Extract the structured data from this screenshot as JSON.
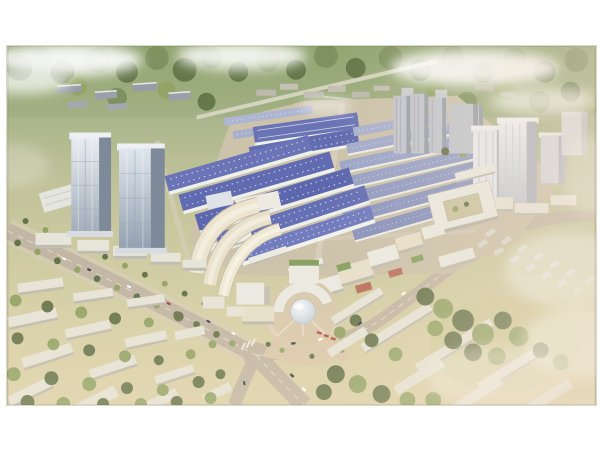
{
  "scene": {
    "type": "aerial-architectural-rendering-photo",
    "description": "Photographed aerial rendering of a planned industrial and commercial park: rows of blue-roofed logistics warehouses, twin glass office towers on the left, a circular plaza with a central dome surrounded by a ring building and fan-shaped cream offices, a white courtyard building and high-rise tower cluster on the right, residential slab towers behind, tree-lined avenues crossing at an intersection in the foreground, low-rise housing blocks among trees at bottom left and right, distant forest, fields and haze clouds at the top",
    "regions": [
      {
        "name": "photo-border",
        "description": "white paper border around the photo"
      },
      {
        "name": "far-forest",
        "description": "distant forest band with low buildings and a diagonal road"
      },
      {
        "name": "clouds",
        "description": "white haze clouds over corners and right side"
      },
      {
        "name": "warehouse-district",
        "description": "rows of blue-roofed warehouses with skylights"
      },
      {
        "name": "office-towers-left",
        "description": "two tall glass office towers with street podium"
      },
      {
        "name": "fan-buildings",
        "description": "curved fan-shaped cream office buildings"
      },
      {
        "name": "central-plaza",
        "description": "circular plaza with dome and ring building"
      },
      {
        "name": "courtyard-building",
        "description": "white square building with inner courtyard"
      },
      {
        "name": "towers-right",
        "description": "cluster of tall white towers"
      },
      {
        "name": "residential-towers",
        "description": "gray residential slab towers"
      },
      {
        "name": "main-avenue",
        "description": "tree-lined avenue crossing the foreground"
      },
      {
        "name": "lowrise-left",
        "description": "low white housing rows among trees, bottom left"
      },
      {
        "name": "lowrise-right",
        "description": "low white housing rows among trees, bottom right"
      }
    ]
  },
  "colors": {
    "frame": "#ffffff",
    "forest": "#7d9160",
    "forest_dark": "#627648",
    "field": "#c2c79b",
    "field_warm": "#d8d1a7",
    "haze_warm": "#eeddc9",
    "road": "#c2b7a5",
    "road_light": "#d8cfbe",
    "roof_blue": "#5d67ae",
    "roof_blue_light": "#98a1c5",
    "wall_white": "#eceae1",
    "slab_white": "#e7e5d9",
    "cream": "#e8e0cb",
    "glass": "#9fabb8",
    "glass_dark": "#7e8a99",
    "dome": "#dde7ec",
    "green_roof": "#8aa364",
    "tree": "#66744a",
    "tree_light": "#93a465",
    "residential": "#c3c6cd",
    "residential_dark": "#9aa0a9",
    "accent_red": "#b4584a",
    "cloud": "#ffffff",
    "yard": "#cdc3ab"
  }
}
